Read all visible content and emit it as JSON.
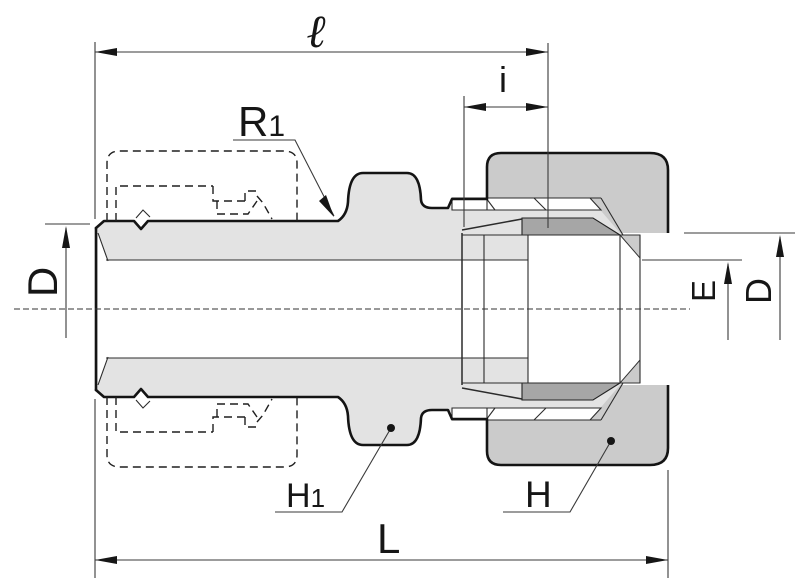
{
  "drawing": {
    "kind": "tube-fitting cross-section dimensional drawing",
    "labels": {
      "overall_body_length_top": "ℓ",
      "insertion_depth": "i",
      "thread_callout": {
        "base": "R",
        "sub": "1"
      },
      "tube_diameter_left": "D",
      "end_bore_diameter": "E",
      "tube_diameter_right": "D",
      "body_hex_callout": {
        "base": "H",
        "sub": "1"
      },
      "nut_hex_callout": "H",
      "overall_length_bottom": "L"
    },
    "colors": {
      "body_fill": "#e3e3e3",
      "nut_fill": "#cbcbcb",
      "ferrule_fill": "#a6a6a6",
      "outline": "#141414",
      "background": "#ffffff"
    }
  }
}
